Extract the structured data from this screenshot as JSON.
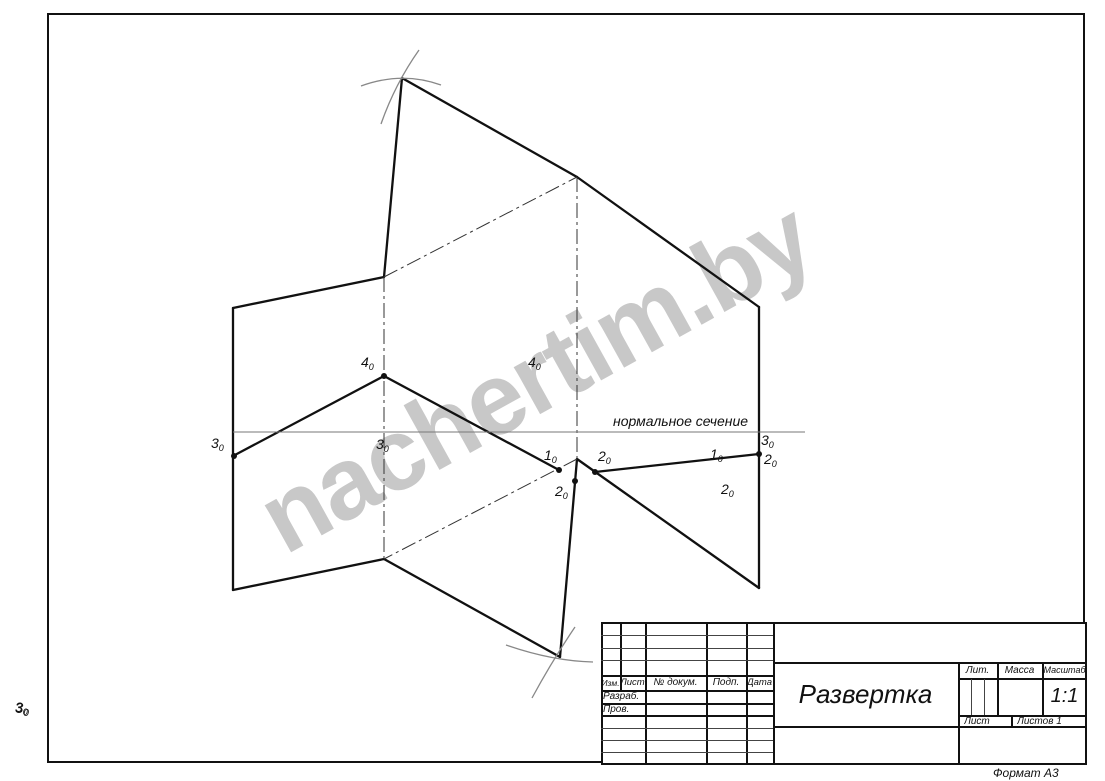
{
  "page": {
    "format_label": "Формат А3"
  },
  "watermark": {
    "text": "nachertim.by",
    "color": "#c8c8c8",
    "rotation_deg": -29
  },
  "drawing": {
    "section_label": "нормальное сечение",
    "outside_label": {
      "m": "3",
      "s": "0"
    },
    "line_color": "#111111",
    "thin_color": "#777777",
    "thick_lines": [
      [
        402,
        78,
        384,
        277
      ],
      [
        384,
        277,
        233,
        308
      ],
      [
        233,
        308,
        233,
        590
      ],
      [
        233,
        590,
        384,
        559
      ],
      [
        384,
        559,
        560,
        657
      ],
      [
        560,
        657,
        577,
        459
      ],
      [
        577,
        459,
        759,
        588
      ],
      [
        402,
        78,
        577,
        177
      ],
      [
        577,
        177,
        759,
        307
      ],
      [
        759,
        307,
        759,
        588
      ],
      [
        233,
        456,
        384,
        376
      ],
      [
        384,
        376,
        559,
        470
      ],
      [
        595,
        472,
        759,
        454
      ]
    ],
    "dashdot_lines": [
      [
        384,
        277,
        384,
        559
      ],
      [
        577,
        177,
        577,
        459
      ],
      [
        384,
        277,
        577,
        177
      ],
      [
        577,
        459,
        384,
        559
      ]
    ],
    "thin_lines": [
      [
        233,
        432,
        805,
        432
      ]
    ],
    "arcs": [
      "M 361 86 Q 402 71 441 85",
      "M 419 50 Q 395 84 381 124",
      "M 506 645 Q 552 661 593 662",
      "M 575 627 Q 552 661 532 698"
    ],
    "dots": [
      [
        234,
        456
      ],
      [
        384,
        376
      ],
      [
        559,
        470
      ],
      [
        575,
        481
      ],
      [
        595,
        472
      ],
      [
        759,
        454
      ]
    ],
    "point_labels": [
      {
        "m": "4",
        "s": "0",
        "x": 361,
        "y": 355
      },
      {
        "m": "4",
        "s": "0",
        "x": 528,
        "y": 355
      },
      {
        "m": "3",
        "s": "0",
        "x": 211,
        "y": 436
      },
      {
        "m": "3",
        "s": "0",
        "x": 376,
        "y": 437
      },
      {
        "m": "1",
        "s": "0",
        "x": 544,
        "y": 448
      },
      {
        "m": "2",
        "s": "0",
        "x": 598,
        "y": 449
      },
      {
        "m": "2",
        "s": "0",
        "x": 555,
        "y": 484
      },
      {
        "m": "1",
        "s": "0",
        "x": 710,
        "y": 447
      },
      {
        "m": "2",
        "s": "0",
        "x": 721,
        "y": 482
      },
      {
        "m": "3",
        "s": "0",
        "x": 761,
        "y": 433
      },
      {
        "m": "2",
        "s": "0",
        "x": 764,
        "y": 452
      },
      {
        "m": "3",
        "s": "0",
        "x": 15,
        "y": 700
      }
    ]
  },
  "title_block": {
    "header_cols": [
      "Изм.",
      "Лист",
      "№ докум.",
      "Подп.",
      "Дата"
    ],
    "rows": [
      "Разраб.",
      "Пров."
    ],
    "doc_title": "Развертка",
    "lit_label": "Лит.",
    "mass_label": "Масса",
    "scale_label": "Масштаб",
    "scale_value": "1:1",
    "sheet_label": "Лист",
    "sheets_label": "Листов 1"
  }
}
